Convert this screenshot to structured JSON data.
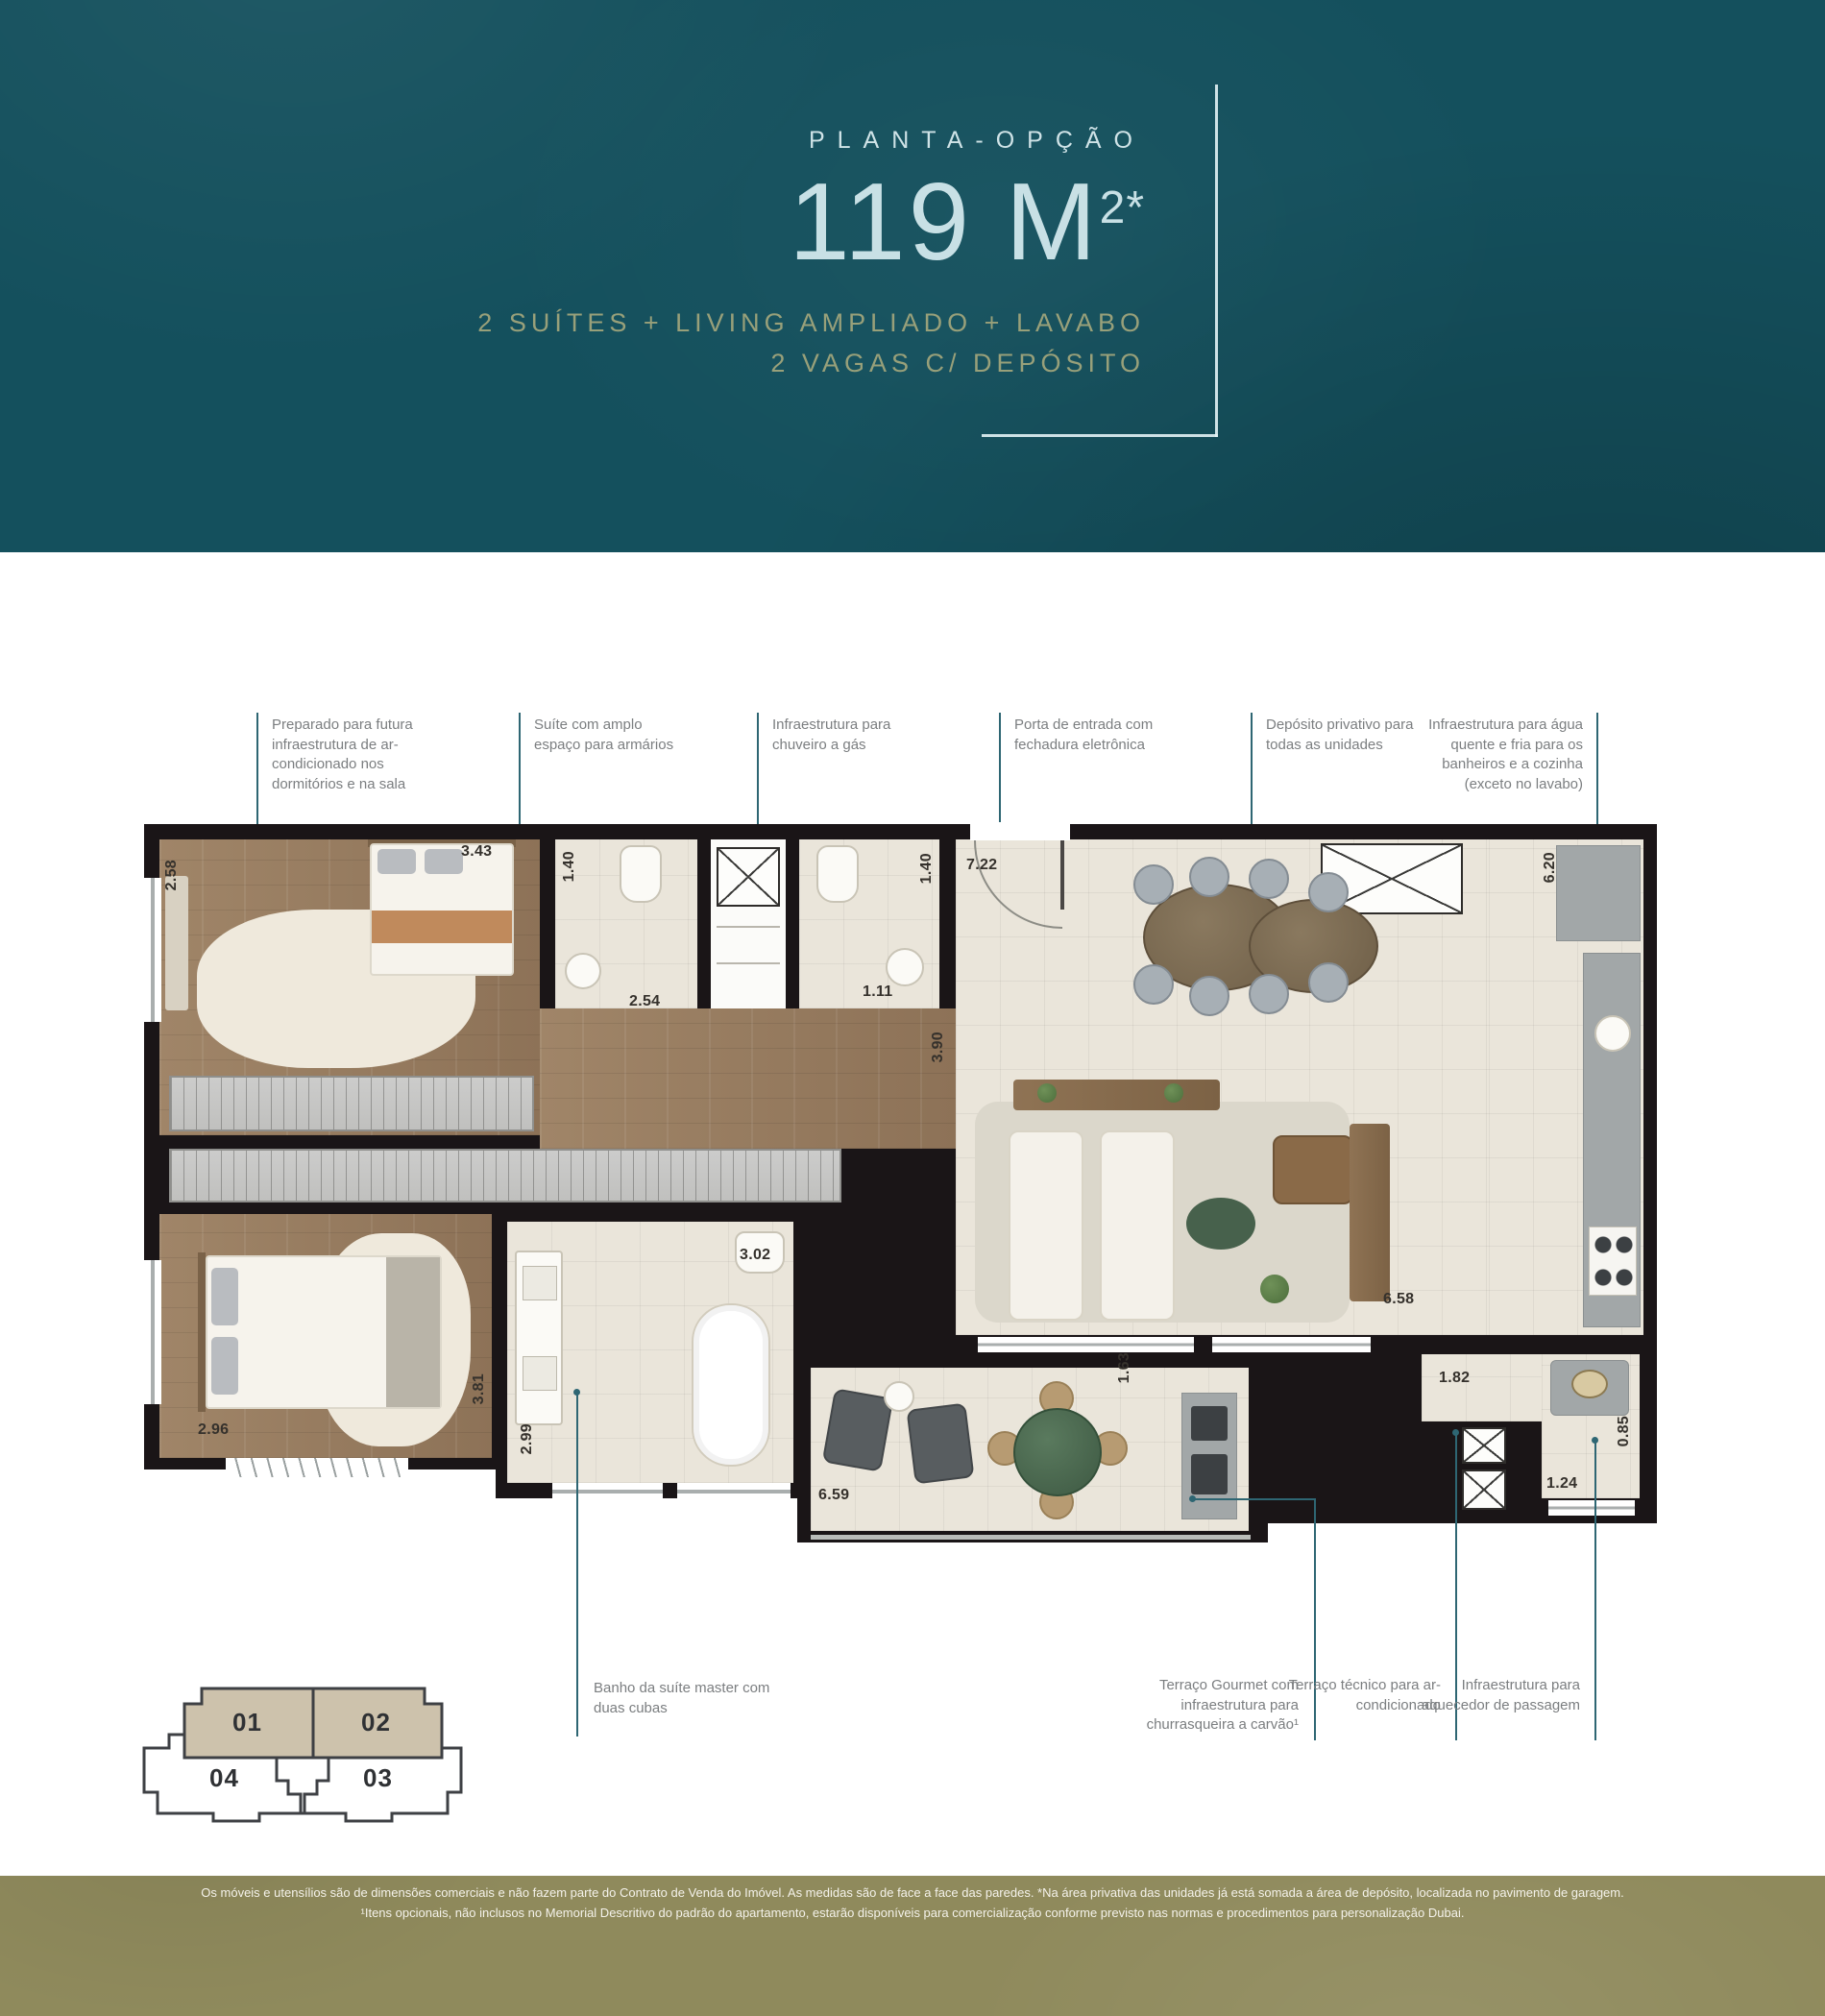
{
  "colors": {
    "header_bg": "#14505d",
    "header_title": "#c8e0e5",
    "header_subtitle": "#98a07a",
    "callout_line": "#2e6673",
    "callout_text": "#7b7e80",
    "wall": "#1a1517",
    "footer_bg": "#8f8a5c",
    "keyplan_highlight": "#cdc2ac"
  },
  "header": {
    "eyebrow": "PLANTA-OPÇÃO",
    "area_main": "119 M",
    "area_sup": "2*",
    "subtitle_line1": "2 SUÍTES + LIVING AMPLIADO + LAVABO",
    "subtitle_line2": "2 VAGAS C/ DEPÓSITO"
  },
  "callouts_top": [
    {
      "text": "Preparado para futura infraestrutura de ar-condicionado nos dormitórios e na sala"
    },
    {
      "text": "Suíte com amplo espaço para armários"
    },
    {
      "text": "Infraestrutura para chuveiro a gás"
    },
    {
      "text": "Porta de entrada com fechadura eletrônica"
    },
    {
      "text": "Depósito privativo para todas as unidades"
    },
    {
      "text": "Infraestrutura para água quente e fria para os banheiros e a cozinha (exceto no lavabo)"
    }
  ],
  "callouts_bottom": [
    {
      "text": "Banho da suíte master com duas cubas"
    },
    {
      "text": "Terraço Gourmet com infraestrutura para churrasqueira a carvão¹"
    },
    {
      "text": "Terraço técnico para ar-condicionado"
    },
    {
      "text": "Infraestrutura para aquecedor de passagem"
    }
  ],
  "dims": [
    "2.58",
    "3.43",
    "1.40",
    "2.54",
    "1.11",
    "1.40",
    "7.22",
    "6.20",
    "3.90",
    "3.02",
    "6.58",
    "2.96",
    "3.81",
    "2.99",
    "6.59",
    "1.63",
    "1.82",
    "0.85",
    "1.24"
  ],
  "key_plan": {
    "unit01": "01",
    "unit02": "02",
    "unit03": "03",
    "unit04": "04"
  },
  "footer": {
    "line1": "Os móveis e utensílios são de dimensões comerciais e não fazem parte do Contrato de Venda do Imóvel. As medidas são de face a face das paredes. *Na área privativa das unidades já está somada a área de depósito, localizada no pavimento de garagem.",
    "line2": "¹Itens opcionais, não inclusos no Memorial Descritivo do padrão do apartamento, estarão disponíveis para comercialização conforme previsto nas normas e procedimentos para personalização Dubai."
  }
}
